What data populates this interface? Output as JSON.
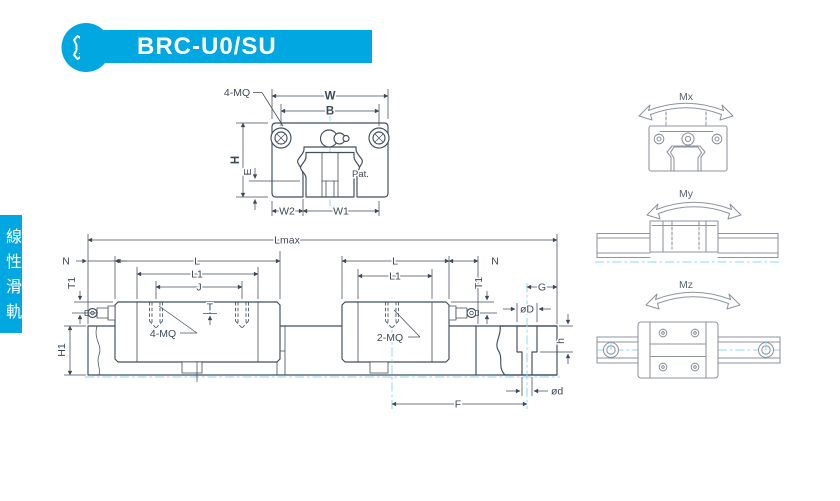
{
  "header": {
    "model": "BRC-U0/SU",
    "logo_letter": "A"
  },
  "side_tab": {
    "label": "線性滑軌"
  },
  "front_view": {
    "labels": {
      "screws": "4-MQ",
      "width": "W",
      "bolt_spacing": "B",
      "height": "H",
      "edge_height": "E",
      "w2": "W2",
      "w1": "W1",
      "patent": "Pat."
    }
  },
  "side_view": {
    "labels": {
      "lmax": "Lmax",
      "n_left": "N",
      "n_right": "N",
      "l_left": "L",
      "l_right": "L",
      "l1_left": "L1",
      "l1_right": "L1",
      "j": "J",
      "t": "T",
      "t1_left": "T1",
      "t1_right": "T1",
      "h1": "H1",
      "screws_left": "4-MQ",
      "screws_right": "2-MQ",
      "g": "G",
      "counterbore_dia": "øD",
      "counterbore_depth": "h",
      "hole_dia": "ød",
      "f": "F"
    }
  },
  "moment_views": {
    "mx": "Mx",
    "my": "My",
    "mz": "Mz"
  },
  "colors": {
    "brand": "#00A7E1",
    "line": "#424D5B",
    "centerline": "#8FD8F2",
    "moment_line": "#8D939E"
  }
}
